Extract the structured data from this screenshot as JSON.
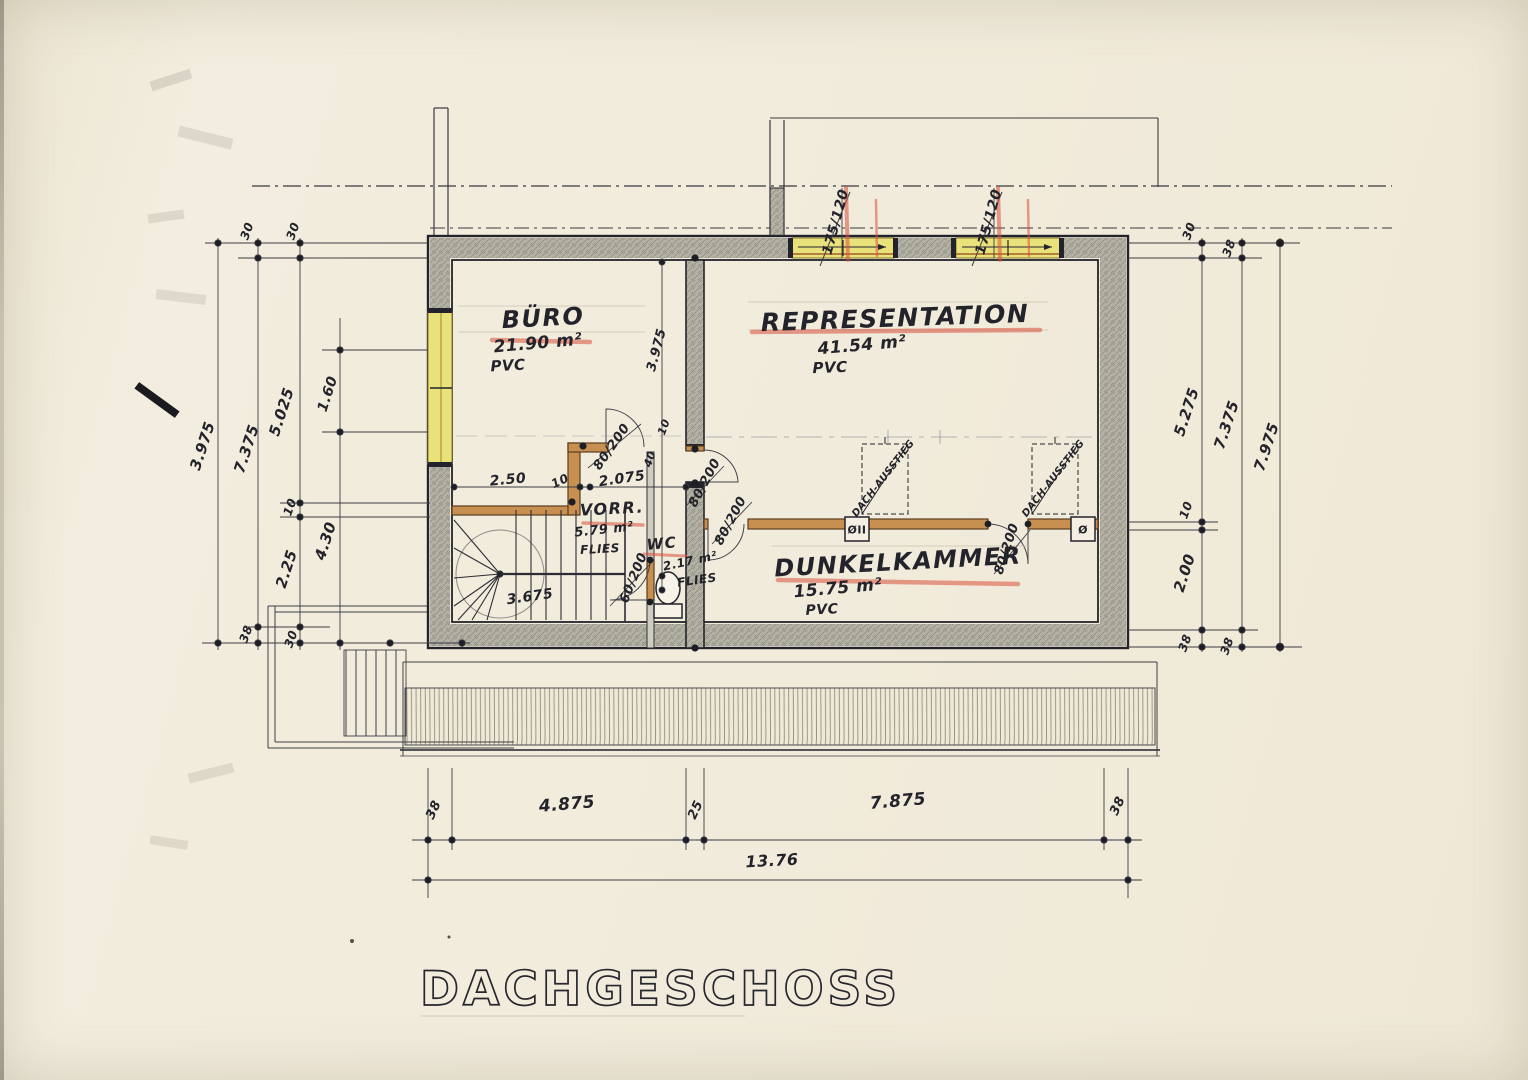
{
  "drawing": {
    "title": "DACHGESCHOSS"
  },
  "rooms": [
    {
      "name": "BÜRO",
      "area": "21.90 m²",
      "floor": "PVC"
    },
    {
      "name": "REPRESENTATION",
      "area": "41.54 m²",
      "floor": "PVC"
    },
    {
      "name": "DUNKELKAMMER",
      "area": "15.75 m²",
      "floor": "PVC"
    },
    {
      "name": "VORR.",
      "area": "5.79 m²",
      "floor": "FLIES"
    },
    {
      "name": "WC",
      "area": "2.17 m²",
      "floor": "FLIES"
    }
  ],
  "openings": {
    "windows": [
      "175/120",
      "175/120"
    ],
    "doors": [
      "80/200",
      "80/200",
      "80/200",
      "80/200",
      "60/200"
    ],
    "roof_access": "DACH-AUSSTIEG",
    "vents": [
      "ØII",
      "Ø"
    ]
  },
  "dimensions": {
    "left": [
      "30",
      "30",
      "3.975",
      "7.375",
      "5.025",
      "1.60",
      "10",
      "2.25",
      "4.30",
      "38",
      "30"
    ],
    "right": [
      "30",
      "38",
      "5.275",
      "7.375",
      "7.975",
      "10",
      "2.00",
      "38",
      "38"
    ],
    "bottom": [
      "38",
      "4.875",
      "25",
      "7.875",
      "38",
      "13.76"
    ],
    "interior": [
      "2.50",
      "10",
      "2.075",
      "40",
      "10",
      "3.975",
      "3.675"
    ]
  },
  "colors": {
    "paper": "#f1ebdb",
    "ink": "#23232b",
    "wall_fill": "#b5b2a6",
    "window_yellow": "#e9e27b",
    "wood_tan": "#c79050",
    "red_crayon": "#d9503c"
  }
}
